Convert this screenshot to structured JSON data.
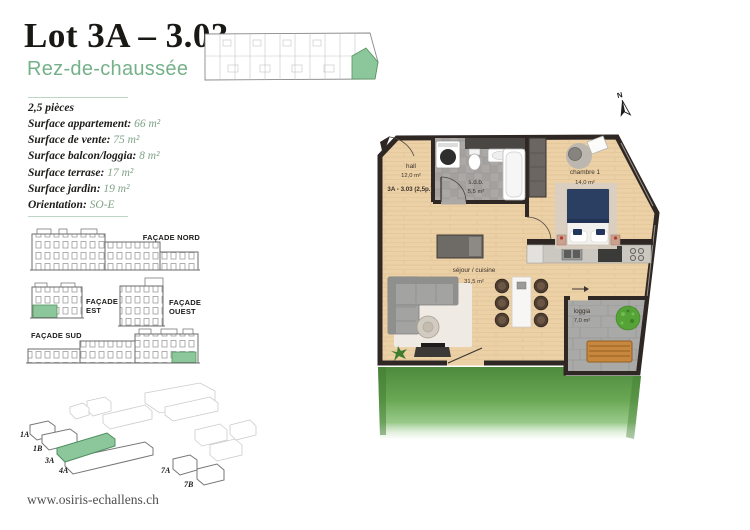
{
  "page": {
    "title": "Lot 3A – 3.03",
    "subtitle": "Rez-de-chaussée",
    "website": "www.osiris-echallens.ch"
  },
  "details": {
    "rooms": "2,5 pièces",
    "items": [
      {
        "label": "Surface appartement:",
        "value": "66 m²"
      },
      {
        "label": "Surface de vente:",
        "value": "75 m²"
      },
      {
        "label": "Surface balcon/loggia:",
        "value": "8 m²"
      },
      {
        "label": "Surface terrase:",
        "value": "17 m²"
      },
      {
        "label": "Surface jardin:",
        "value": "19 m²"
      },
      {
        "label": "Orientation:",
        "value": "SO-E"
      }
    ]
  },
  "facades": {
    "nord": "FAÇADE NORD",
    "est": "FAÇADE EST",
    "ouest": "FAÇADE OUEST",
    "sud": "FAÇADE SUD"
  },
  "siteplan": {
    "buildings": [
      "1A",
      "1B",
      "3A",
      "4A",
      "7A",
      "7B"
    ],
    "highlighted": "3A"
  },
  "floorplan": {
    "unit_label": "3A - 3.03 (2,5p.)",
    "north_label": "N",
    "rooms": [
      {
        "name": "hall",
        "area": "12,0 m²"
      },
      {
        "name": "s.d.b.",
        "area": "5,5 m²"
      },
      {
        "name": "chambre 1",
        "area": "14,0 m²"
      },
      {
        "name": "séjour / cuisine",
        "area": "31,5 m²"
      },
      {
        "name": "loggia",
        "area": "7,0 m²"
      }
    ]
  },
  "colors": {
    "accent_green": "#74b189",
    "highlight_green": "#8cc79b",
    "values_green": "#7fa287",
    "title": "#1d1c1a",
    "walls": "#2e2724",
    "wood": "#ecd0a6",
    "grass": "#5f9c46"
  }
}
